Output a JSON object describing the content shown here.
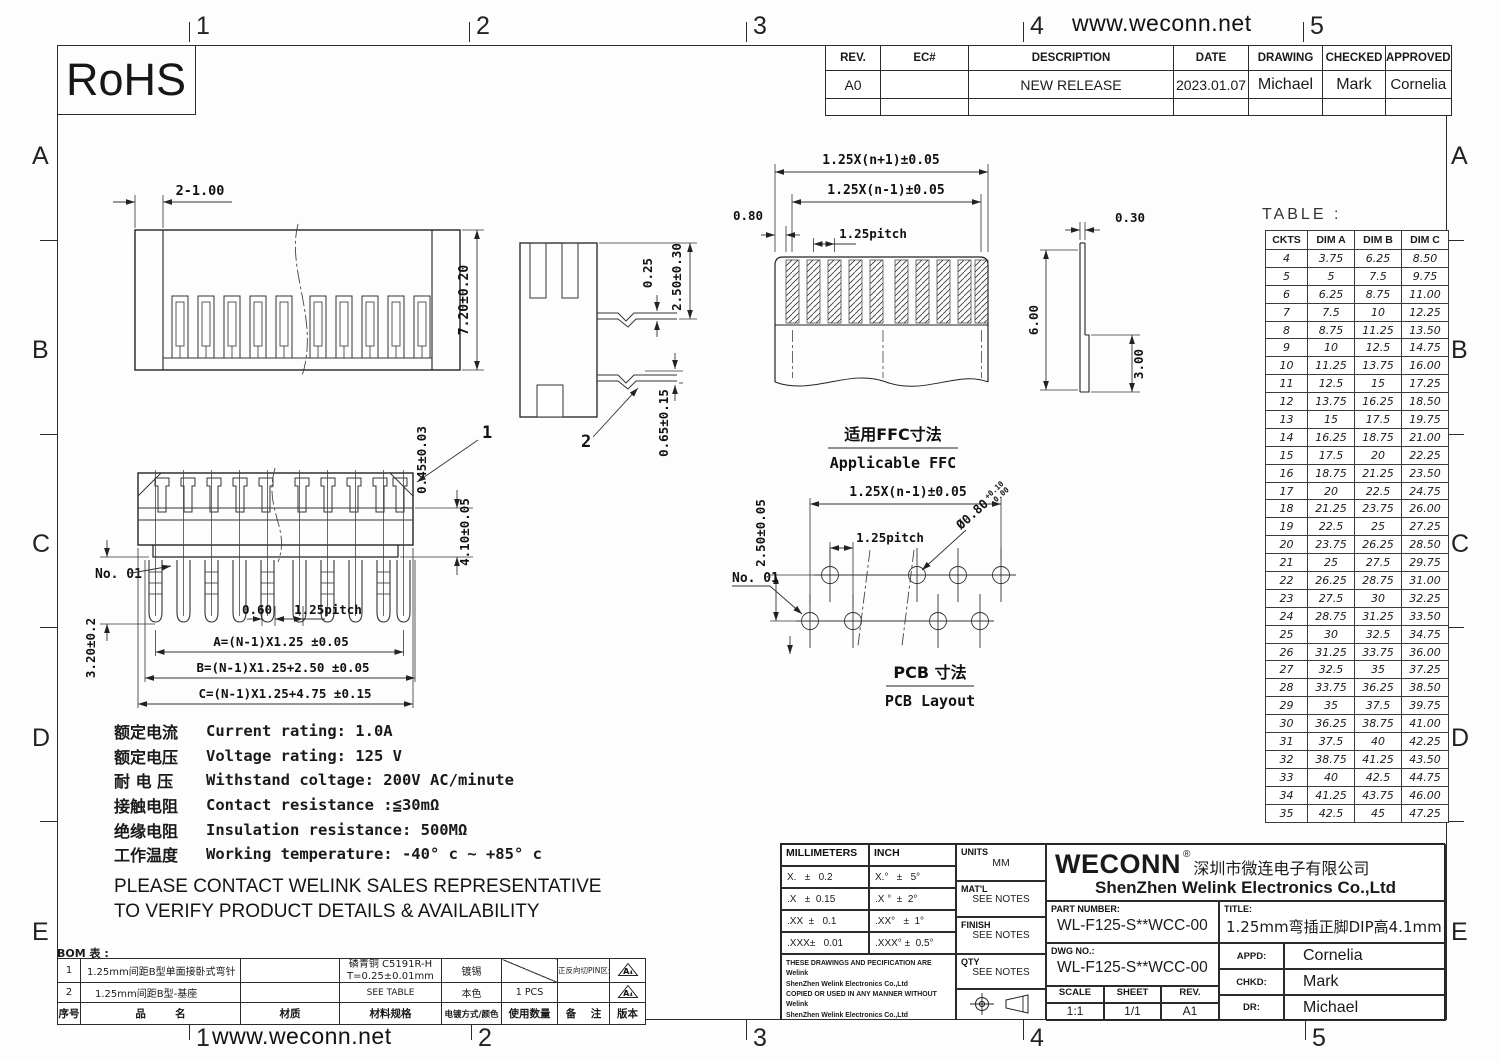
{
  "page": {
    "website": "www.weconn.net",
    "rohs": "RoHS",
    "zone_numbers": [
      "1",
      "2",
      "3",
      "4",
      "5"
    ],
    "zone_letters": [
      "A",
      "B",
      "C",
      "D",
      "E"
    ]
  },
  "revision_table": {
    "headers": [
      "REV.",
      "EC#",
      "DESCRIPTION",
      "DATE",
      "DRAWING",
      "CHECKED",
      "APPROVED"
    ],
    "rows": [
      [
        "A0",
        "",
        "NEW RELEASE",
        "2023.01.07",
        "Michael",
        "Mark",
        "Cornelia"
      ]
    ]
  },
  "front_view": {
    "dim_end_holes": "2-1.00",
    "dim_height": "7.20±0.20"
  },
  "side_view": {
    "dim_pin_thk": "0.25",
    "dim_height": "2.50±0.30",
    "dim_offset": "0.65±0.15",
    "balloon": "2"
  },
  "bottom_view": {
    "dim_chamfer": "0.45±0.03",
    "balloon": "1",
    "dim_depth": "4.10±0.05",
    "pin1_label": "No. 01",
    "dim_pin_len": "3.20±0.2",
    "dim_slot": "0.60",
    "dim_pitch": "1.25pitch",
    "dim_a": "A=(N-1)X1.25 ±0.05",
    "dim_b": "B=(N-1)X1.25+2.50 ±0.05",
    "dim_c": "C=(N-1)X1.25+4.75 ±0.15"
  },
  "ffc_view": {
    "dim_total": "1.25X(n+1)±0.05",
    "dim_inner": "1.25X(n-1)±0.05",
    "dim_pitch": "1.25pitch",
    "dim_margin": "0.80",
    "dim_thk": "0.30",
    "dim_exposed": "6.00",
    "dim_stiffener": "3.00",
    "caption_cn": "适用FFC寸法",
    "caption_en": "Applicable FFC"
  },
  "pcb_view": {
    "dim_span": "1.25X(n-1)±0.05",
    "dim_rows": "2.50±0.05",
    "dim_pitch": "1.25pitch",
    "dim_hole": "Ø0.80",
    "tol_plus": "+0.10",
    "tol_minus": "-0.00",
    "pin1_label": "No. 01",
    "caption_cn": "PCB  寸法",
    "caption_en": "PCB Layout"
  },
  "dim_table": {
    "title": "TABLE :",
    "headers": [
      "CKTS",
      "DIM A",
      "DIM B",
      "DIM C"
    ],
    "rows": [
      [
        "4",
        "3.75",
        "6.25",
        "8.50"
      ],
      [
        "5",
        "5",
        "7.5",
        "9.75"
      ],
      [
        "6",
        "6.25",
        "8.75",
        "11.00"
      ],
      [
        "7",
        "7.5",
        "10",
        "12.25"
      ],
      [
        "8",
        "8.75",
        "11.25",
        "13.50"
      ],
      [
        "9",
        "10",
        "12.5",
        "14.75"
      ],
      [
        "10",
        "11.25",
        "13.75",
        "16.00"
      ],
      [
        "11",
        "12.5",
        "15",
        "17.25"
      ],
      [
        "12",
        "13.75",
        "16.25",
        "18.50"
      ],
      [
        "13",
        "15",
        "17.5",
        "19.75"
      ],
      [
        "14",
        "16.25",
        "18.75",
        "21.00"
      ],
      [
        "15",
        "17.5",
        "20",
        "22.25"
      ],
      [
        "16",
        "18.75",
        "21.25",
        "23.50"
      ],
      [
        "17",
        "20",
        "22.5",
        "24.75"
      ],
      [
        "18",
        "21.25",
        "23.75",
        "26.00"
      ],
      [
        "19",
        "22.5",
        "25",
        "27.25"
      ],
      [
        "20",
        "23.75",
        "26.25",
        "28.50"
      ],
      [
        "21",
        "25",
        "27.5",
        "29.75"
      ],
      [
        "22",
        "26.25",
        "28.75",
        "31.00"
      ],
      [
        "23",
        "27.5",
        "30",
        "32.25"
      ],
      [
        "24",
        "28.75",
        "31.25",
        "33.50"
      ],
      [
        "25",
        "30",
        "32.5",
        "34.75"
      ],
      [
        "26",
        "31.25",
        "33.75",
        "36.00"
      ],
      [
        "27",
        "32.5",
        "35",
        "37.25"
      ],
      [
        "28",
        "33.75",
        "36.25",
        "38.50"
      ],
      [
        "29",
        "35",
        "37.5",
        "39.75"
      ],
      [
        "30",
        "36.25",
        "38.75",
        "41.00"
      ],
      [
        "31",
        "37.5",
        "40",
        "42.25"
      ],
      [
        "32",
        "38.75",
        "41.25",
        "43.50"
      ],
      [
        "33",
        "40",
        "42.5",
        "44.75"
      ],
      [
        "34",
        "41.25",
        "43.75",
        "46.00"
      ],
      [
        "35",
        "42.5",
        "45",
        "47.25"
      ]
    ]
  },
  "specs": {
    "lines": [
      {
        "cn": "额定电流",
        "en": "Current rating: 1.0A"
      },
      {
        "cn": "额定电压",
        "en": "Voltage rating: 125 V"
      },
      {
        "cn": "耐 电 压",
        "en": "Withstand coltage: 200V AC/minute"
      },
      {
        "cn": "接触电阻",
        "en": "Contact resistance :≦30mΩ"
      },
      {
        "cn": "绝缘电阻",
        "en": "Insulation resistance: 500MΩ"
      },
      {
        "cn": "工作温度",
        "en": "Working temperature: -40° c ~ +85° c"
      }
    ],
    "note1": "PLEASE CONTACT WELINK SALES REPRESENTATIVE",
    "note2": "TO VERIFY PRODUCT DETAILS & AVAILABILITY"
  },
  "bom": {
    "title": "BOM 表 :",
    "row1": {
      "no": "1",
      "name": "1.25mm间距B型单面接卧式弯针",
      "material": "",
      "spec_line1": "磷青铜 C5191R-H",
      "spec_line2": "T=0.25±0.01mm",
      "plating": "镀锡",
      "qty": "",
      "remark": "正反向切PIN区分",
      "rev": "A₄"
    },
    "row2": {
      "no": "2",
      "name": "1.25mm间距B型-基座",
      "material": "",
      "spec": "SEE TABLE",
      "plating": "本色",
      "qty": "1 PCS",
      "remark": "",
      "rev": "A₄"
    },
    "headers": {
      "no": "序号",
      "name": "品        名",
      "material": "材质",
      "spec": "材料规格",
      "plating": "电镀方式/颜色",
      "qty": "使用数量",
      "remark": "备    注",
      "rev": "版本"
    }
  },
  "title_block": {
    "tol_mm_header": "MILLIMETERS",
    "tol_inch_header": "INCH",
    "tol_rows": [
      [
        "X.   ±   0.2",
        "X.°   ±   5°"
      ],
      [
        ".X   ±  0.15",
        ".X °  ±  2°"
      ],
      [
        ".XX  ±   0.1",
        ".XX°   ±  1°"
      ],
      [
        ".XXX±   0.01",
        ".XXX° ±  0.5°"
      ]
    ],
    "units_label": "UNITS",
    "units_value": "MM",
    "matl_label": "MAT'L",
    "matl_value": "SEE NOTES",
    "finish_label": "FINISH",
    "finish_value": "SEE NOTES",
    "qty_label": "QTY",
    "qty_value": "SEE NOTES",
    "disclaimer_lines": [
      "THESE DRAWINGS AND PECIFICATION  ARE Welink",
      "ShenZhen Welink Electronics Co.,Ltd",
      "COPIED OR USED IN ANY MANNER WITHOUT Welink",
      "ShenZhen Welink Electronics Co.,Ltd"
    ],
    "brand": "WECONN",
    "brand_reg": "®",
    "company_cn": "深圳市微连电子有限公司",
    "company_en": "ShenZhen Welink Electronics Co.,Ltd",
    "part_number_label": "PART NUMBER:",
    "part_number": "WL-F125-S**WCC-00",
    "title_label": "TITLE:",
    "title": "1.25mm弯插正脚DIP高4.1mm",
    "dwg_no_label": "DWG NO.:",
    "dwg_no": "WL-F125-S**WCC-00",
    "scale_label": "SCALE",
    "scale": "1:1",
    "sheet_label": "SHEET",
    "sheet": "1/1",
    "rev_label": "REV.",
    "rev": "A1",
    "appd_label": "APPD:",
    "appd": "Cornelia",
    "chkd_label": "CHKD:",
    "chkd": "Mark",
    "dr_label": "DR:",
    "dr": "Michael"
  }
}
